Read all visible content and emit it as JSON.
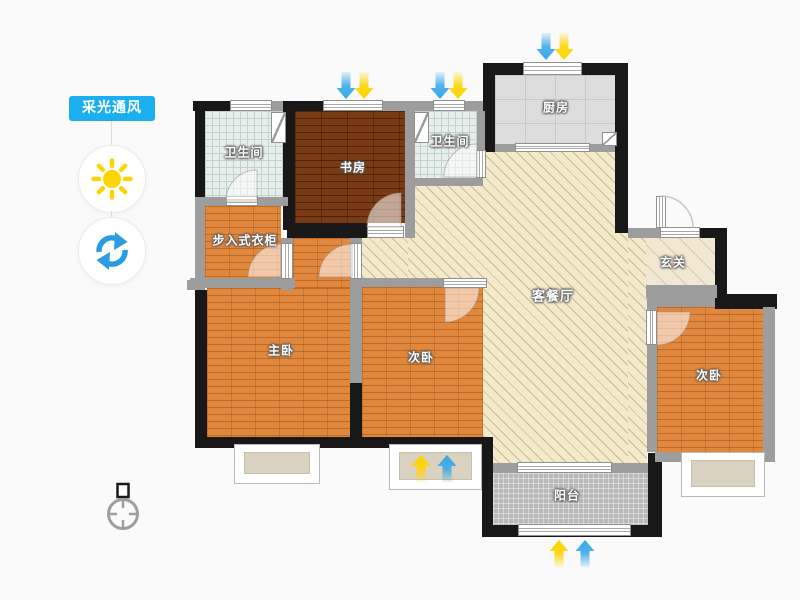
{
  "sidebar": {
    "tool_label": "采光通风",
    "buttons": [
      {
        "name": "daylight",
        "icon": "sun-icon"
      },
      {
        "name": "ventilation",
        "icon": "refresh-icon"
      }
    ]
  },
  "rooms": {
    "bathroom1": {
      "label": "卫生间"
    },
    "study": {
      "label": "书房"
    },
    "bathroom2": {
      "label": "卫生间"
    },
    "kitchen": {
      "label": "厨房"
    },
    "closet": {
      "label": "步入式衣柜"
    },
    "entry": {
      "label": "玄关"
    },
    "living": {
      "label": "客餐厅"
    },
    "master": {
      "label": "主卧"
    },
    "bedroom_mid": {
      "label": "次卧"
    },
    "bedroom_right": {
      "label": "次卧"
    },
    "balcony": {
      "label": "阳台"
    }
  },
  "light_arrows": [
    {
      "at": "study-north-window",
      "direction": "down",
      "order": [
        "blue",
        "yellow"
      ]
    },
    {
      "at": "bathroom2-north-window",
      "direction": "down",
      "order": [
        "blue",
        "yellow"
      ]
    },
    {
      "at": "kitchen-north-window",
      "direction": "down",
      "order": [
        "blue",
        "yellow"
      ]
    },
    {
      "at": "bedroom-mid-bay-window",
      "direction": "up",
      "order": [
        "yellow",
        "blue"
      ]
    },
    {
      "at": "balcony-south",
      "direction": "up",
      "order": [
        "yellow",
        "blue"
      ]
    }
  ],
  "colors": {
    "accent": "#1caff0",
    "arrow-blue": "#33a7ea",
    "arrow-yellow": "#ffd400",
    "wall-black": "#181818",
    "wall-gray": "#9d9d9d",
    "wood-orange": "#e0883e",
    "wood-dark": "#7a3a14",
    "bath-tile": "#e7eeec",
    "kitchen-tile": "#dddddd",
    "living-beige": "#f3e9cb",
    "balcony-gray": "#b9b9b9"
  }
}
